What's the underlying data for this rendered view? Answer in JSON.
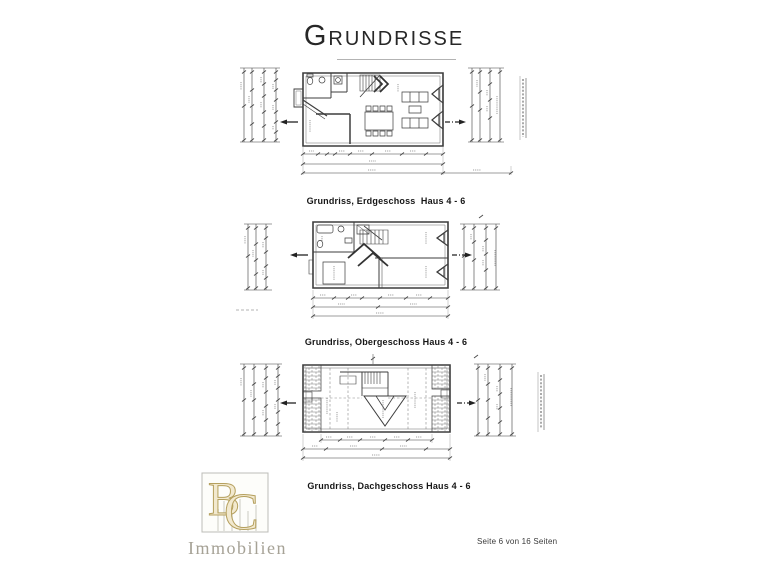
{
  "page": {
    "title": "Grundrisse",
    "footer": "Seite 6 von 16 Seiten"
  },
  "figures": [
    {
      "id": "erdgeschoss",
      "caption": "Grundriss, Erdgeschoss  Haus 4 - 6"
    },
    {
      "id": "obergeschoss",
      "caption": "Grundriss, Obergeschoss Haus 4 - 6"
    },
    {
      "id": "dachgeschoss",
      "caption": "Grundriss, Dachgeschoss Haus 4 - 6"
    }
  ],
  "logo": {
    "monogram_b": "B",
    "monogram_c": "C",
    "name": "Immobilien"
  },
  "colors": {
    "ink": "#3d3d3d",
    "ink_light": "#6b6b6b",
    "caption": "#161616",
    "gold_stroke": "#b5a05e",
    "gold_fill": "#f2e9cf",
    "logo_frame": "#bdbdb8"
  }
}
